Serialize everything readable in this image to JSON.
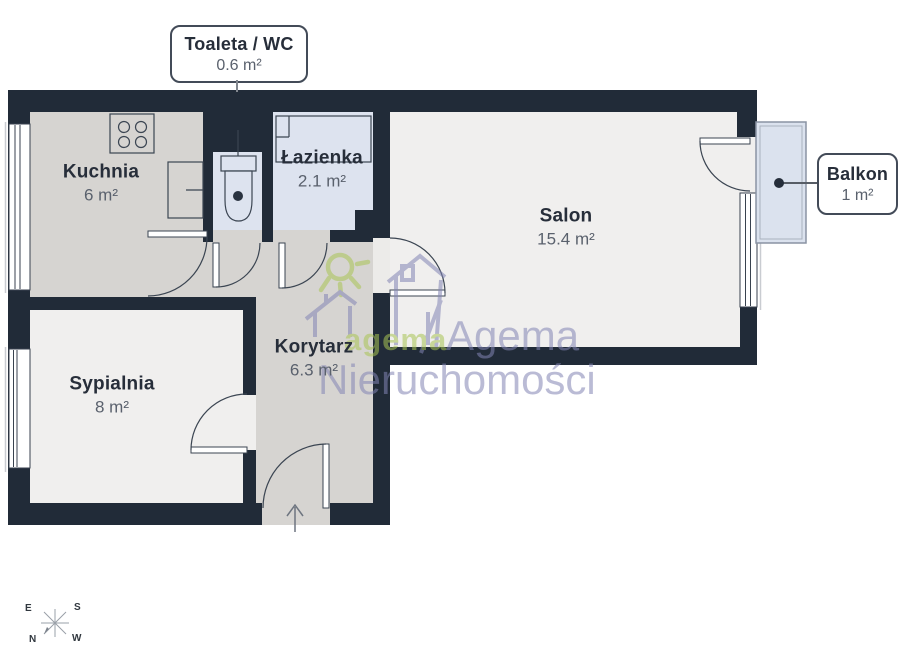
{
  "rooms": {
    "toaleta": {
      "name": "Toaleta / WC",
      "area": "0.6 m²"
    },
    "kuchnia": {
      "name": "Kuchnia",
      "area": "6 m²"
    },
    "lazienka": {
      "name": "Łazienka",
      "area": "2.1 m²"
    },
    "salon": {
      "name": "Salon",
      "area": "15.4 m²"
    },
    "balkon": {
      "name": "Balkon",
      "area": "1 m²"
    },
    "sypialnia": {
      "name": "Sypialnia",
      "area": "8 m²"
    },
    "korytarz": {
      "name": "Korytarz",
      "area": "6.3 m²"
    }
  },
  "watermark": {
    "logo_text": "agema",
    "brand": "Agema",
    "brand_line2": "Nieruchomości"
  },
  "compass": {
    "top_left": "E",
    "top_right": "S",
    "bottom_left": "N",
    "bottom_right": "W"
  },
  "colors": {
    "wall": "#212b38",
    "floor_warm_gray": "#d6d4d1",
    "floor_light": "#f0efee",
    "floor_blue": "#dde3ef",
    "watermark_green": "#a9c455",
    "watermark_purple": "#8385b4"
  }
}
